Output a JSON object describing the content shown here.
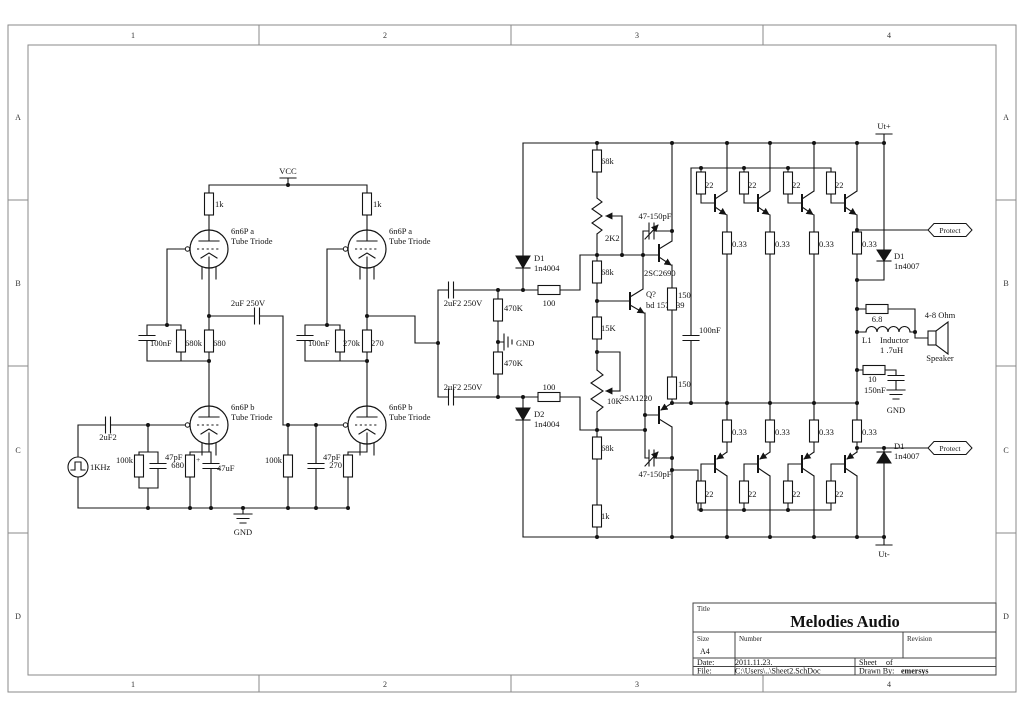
{
  "frame": {
    "n1": "1",
    "n2": "2",
    "n3": "3",
    "n4": "4",
    "rA": "A",
    "rB": "B",
    "rC": "C",
    "rD": "D"
  },
  "tb": {
    "title_label": "Title",
    "title": "Melodies Audio",
    "size_label": "Size",
    "size": "A4",
    "number_label": "Number",
    "revision_label": "Revision",
    "date_label": "Date:",
    "date": "2011.11.23.",
    "sheet_label": "Sheet",
    "of": "of",
    "file_label": "File:",
    "file": "C:\\Users\\..\\Sheet2.SchDoc",
    "drawn_label": "Drawn By:",
    "drawn_by": "emersys"
  },
  "power": {
    "vcc": "VCC",
    "utp": "Ut+",
    "utn": "Ut-",
    "gnd": "GND"
  },
  "tubes": {
    "a": "6n6P a",
    "b": "6n6P b",
    "type": "Tube Triode"
  },
  "left": {
    "rp": "1k",
    "cc": "2uF 250V",
    "c1": "100nF",
    "r680k": "680k",
    "r680": "680",
    "r270k": "270k",
    "r270": "270",
    "cin": "2uF2",
    "src": "1KHz",
    "rg": "100k",
    "cg": "47pF",
    "rk": "680",
    "ck": "47uF",
    "plus": "+",
    "rk2": "270"
  },
  "mid": {
    "cc": "2uF2 250V",
    "r470": "470K",
    "r100": "100",
    "d1": "D1",
    "d2": "D2",
    "dtype": "1n4004"
  },
  "vas": {
    "r68": "68k",
    "p1": "2K2",
    "r15": "15K",
    "p2": "10K",
    "r1": "1k",
    "cv": "47-150pF",
    "q1": "2SC2690",
    "q2": "Q?",
    "q2t": "bd 157/139",
    "q3": "2SA1220",
    "r150": "150",
    "c100": "100nF"
  },
  "out": {
    "rb": "22",
    "re": "0.33",
    "prot": "Protect",
    "d": "D1",
    "dtype": "1n4007",
    "r68": "6.8",
    "l": "L1",
    "lname": "Inductor",
    "lval": "1 .7uH",
    "imp": "4-8 Ohm",
    "spk": "Speaker",
    "rz": "10",
    "cz": "150nF"
  }
}
